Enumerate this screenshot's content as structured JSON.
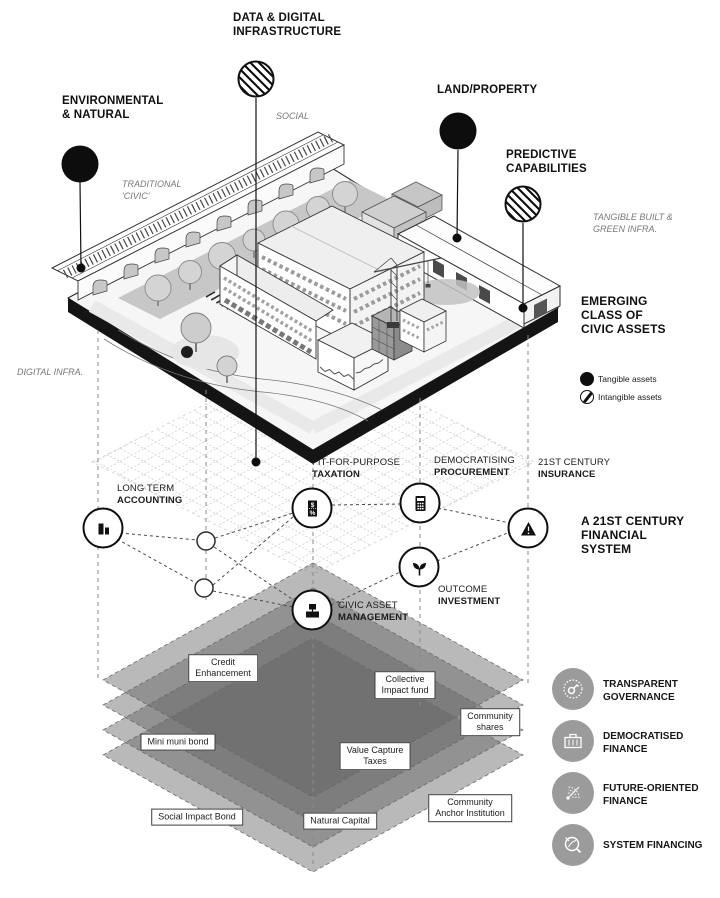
{
  "diagram": {
    "assets": {
      "environmental": {
        "line1": "ENVIRONMENTAL",
        "line2": "& NATURAL"
      },
      "data_digital": {
        "line1": "DATA & DIGITAL",
        "line2": "INFRASTRUCTURE"
      },
      "land_property": {
        "line1": "LAND/PROPERTY"
      },
      "predictive": {
        "line1": "PREDICTIVE",
        "line2": "CAPABILITIES"
      }
    },
    "context": {
      "social": "SOCIAL",
      "traditional_line1": "TRADITIONAL",
      "traditional_line2": "'CIVIC'",
      "tangible_line1": "TANGIBLE BUILT &",
      "tangible_line2": "GREEN INFRA.",
      "digital": "DIGITAL INFRA."
    },
    "emerging": {
      "line1": "EMERGING",
      "line2": "CLASS OF",
      "line3": "CIVIC ASSETS"
    },
    "asset_legend": {
      "tangible": "Tangible assets",
      "intangible": "Intangible assets"
    },
    "financial": {
      "heading": {
        "line1": "A 21ST CENTURY",
        "line2": "FINANCIAL",
        "line3": "SYSTEM"
      },
      "accounting": {
        "line1": "LONG TERM",
        "line2": "ACCOUNTING"
      },
      "taxation": {
        "line1": "FIT-FOR-PURPOSE",
        "line2": "TAXATION"
      },
      "procurement": {
        "line1": "DEMOCRATISING",
        "line2": "PROCUREMENT"
      },
      "insurance": {
        "line1": "21ST CENTURY",
        "line2": "INSURANCE"
      },
      "outcome": {
        "line1": "OUTCOME",
        "line2": "INVESTMENT"
      },
      "civic": {
        "line1": "CIVIC ASSET",
        "line2": "MANAGEMENT"
      },
      "taxation_icon_top": "$",
      "taxation_icon_bottom": "%"
    },
    "mechanisms": {
      "credit": {
        "line1": "Credit",
        "line2": "Enhancement"
      },
      "collective": {
        "line1": "Collective",
        "line2": "Impact fund"
      },
      "shares": {
        "line1": "Community",
        "line2": "shares"
      },
      "mini": {
        "line1": "Mini muni bond"
      },
      "value": {
        "line1": "Value Capture",
        "line2": "Taxes"
      },
      "social_bond": {
        "line1": "Social Impact Bond"
      },
      "natural": {
        "line1": "Natural Capital"
      },
      "anchor": {
        "line1": "Community",
        "line2": "Anchor Institution"
      }
    },
    "principles": {
      "governance": {
        "line1": "TRANSPARENT",
        "line2": "GOVERNANCE"
      },
      "democratised": {
        "line1": "DEMOCRATISED",
        "line2": "FINANCE"
      },
      "future": {
        "line1": "FUTURE-ORIENTED",
        "line2": "FINANCE"
      },
      "system": {
        "line1": "SYSTEM FINANCING"
      }
    },
    "colors": {
      "ink": "#111111",
      "context_gray": "#787878",
      "stack_layer_gray": "#8f8f8f",
      "principle_gray": "#9b9b9b"
    }
  }
}
